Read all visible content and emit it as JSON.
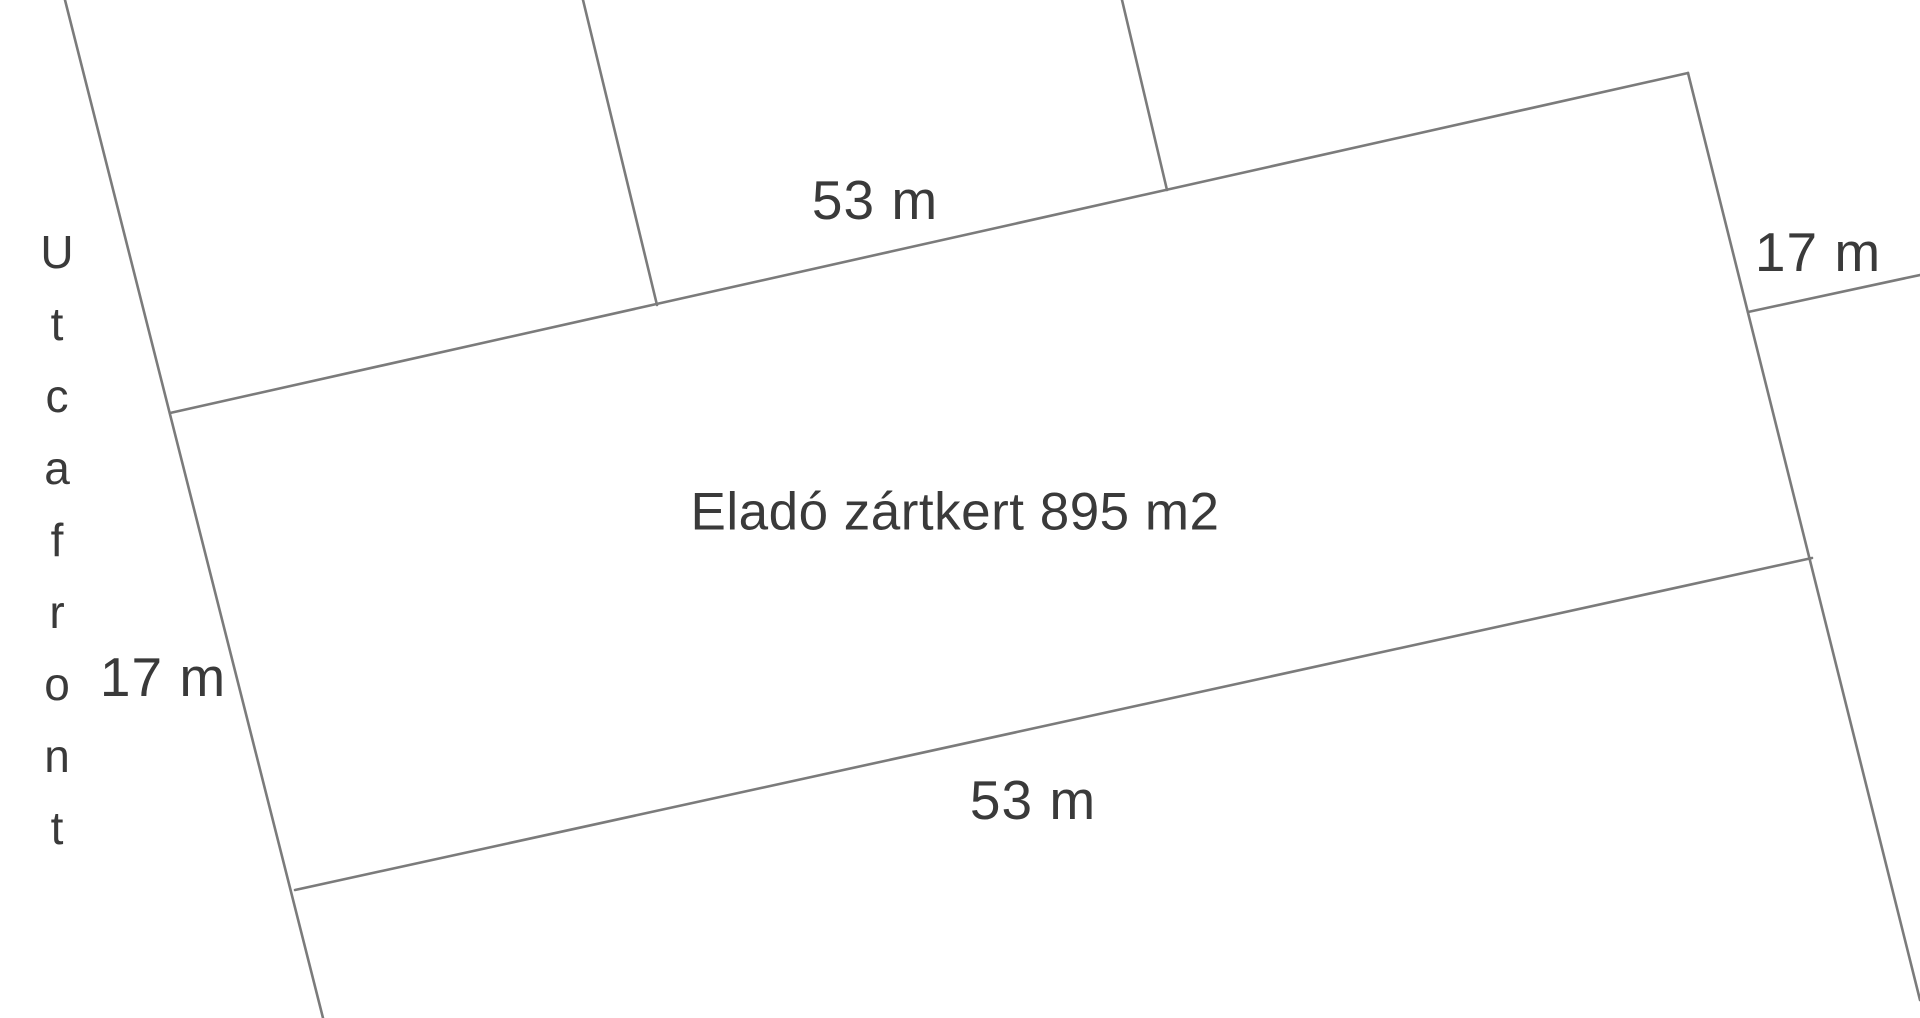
{
  "canvas": {
    "width": 1920,
    "height": 1018,
    "background": "#ffffff"
  },
  "colors": {
    "line": "#7b7b7b",
    "text": "#3a3a3a"
  },
  "plot": {
    "label": "Eladó zártkert 895 m2",
    "area": "895 m2"
  },
  "street": {
    "label": "Utcafront",
    "letters": "U\nt\nc\na\nf\nr\no\nn\nt"
  },
  "dimensions": {
    "top": "53 m",
    "bottom": "53 m",
    "left": "17 m",
    "right": "17 m"
  }
}
